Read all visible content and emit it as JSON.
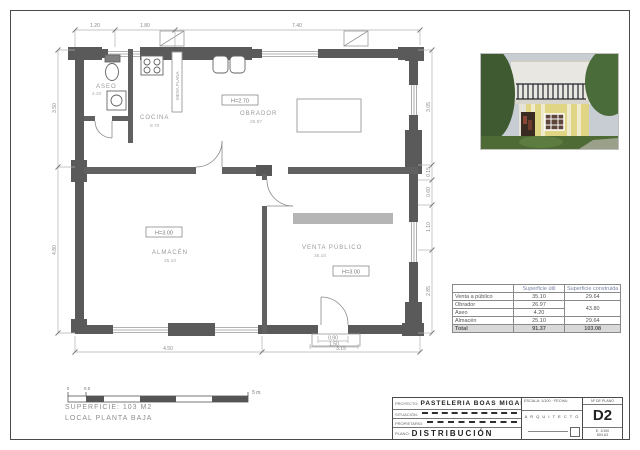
{
  "plan": {
    "rooms": {
      "aseo": {
        "name": "ASEO",
        "area": "4.20"
      },
      "cocina": {
        "name": "COCINA",
        "area": "8.70"
      },
      "obrador": {
        "name": "OBRADOR",
        "area": "26.97"
      },
      "almacen": {
        "name": "ALMACÉN",
        "area": "25.10"
      },
      "venta": {
        "name": "VENTA PÚBLICO",
        "area": "35.10"
      }
    },
    "heights": {
      "obrador": "H=2.70",
      "almacen": "H=3.00",
      "venta": "H=3.00"
    },
    "counter_label": "MESA PLANA",
    "dims": {
      "top": [
        "1.20",
        "1.80",
        "7.40"
      ],
      "bottom": [
        "4.50",
        "3.15"
      ],
      "door": [
        "0.90",
        "1.50"
      ],
      "right": [
        "3.05",
        "0.15",
        "0.60",
        "1.10",
        "2.85"
      ],
      "left": [
        "3.50",
        "4.80"
      ]
    }
  },
  "scale_bar": {
    "zero": "0",
    "half": "0.5",
    "end": "5 m."
  },
  "notes": {
    "superficie": "SUPERFICIE: 103 M2",
    "local": "LOCAL PLANTA BAJA"
  },
  "areas_table": {
    "col_util": "Superficie útil",
    "col_built": "Superficie construida",
    "rows": {
      "venta": {
        "label": "Venta a público",
        "util": "35.10",
        "built": "29.64"
      },
      "obrador": {
        "label": "Obrador",
        "util": "26.97",
        "built_merged": "43.80"
      },
      "aseo": {
        "label": "Aseo",
        "util": "4.20"
      },
      "almacen": {
        "label": "Almacén",
        "util": "25.10",
        "built": "29.64"
      },
      "total": {
        "label": "Total",
        "util": "91.37",
        "built": "103.08"
      }
    }
  },
  "title_block": {
    "proyecto_label": "PROYECTO:",
    "proyecto": "PASTELERIA BOAS MIGAS",
    "situacion_label": "SITUACIÓN:",
    "propietario_label": "PROPIETARIO:",
    "plano_label": "PLANO:",
    "plano": "DISTRIBUCIÓN",
    "escala_fecha": "ESCALA: 1/100 · FECHA:",
    "arquitecto": "A R Q U I T E C T O",
    "num_label": "Nº DE PLANO",
    "num": "D2",
    "num_sub1": "E: 1/100",
    "num_sub2": "DIN A3"
  }
}
